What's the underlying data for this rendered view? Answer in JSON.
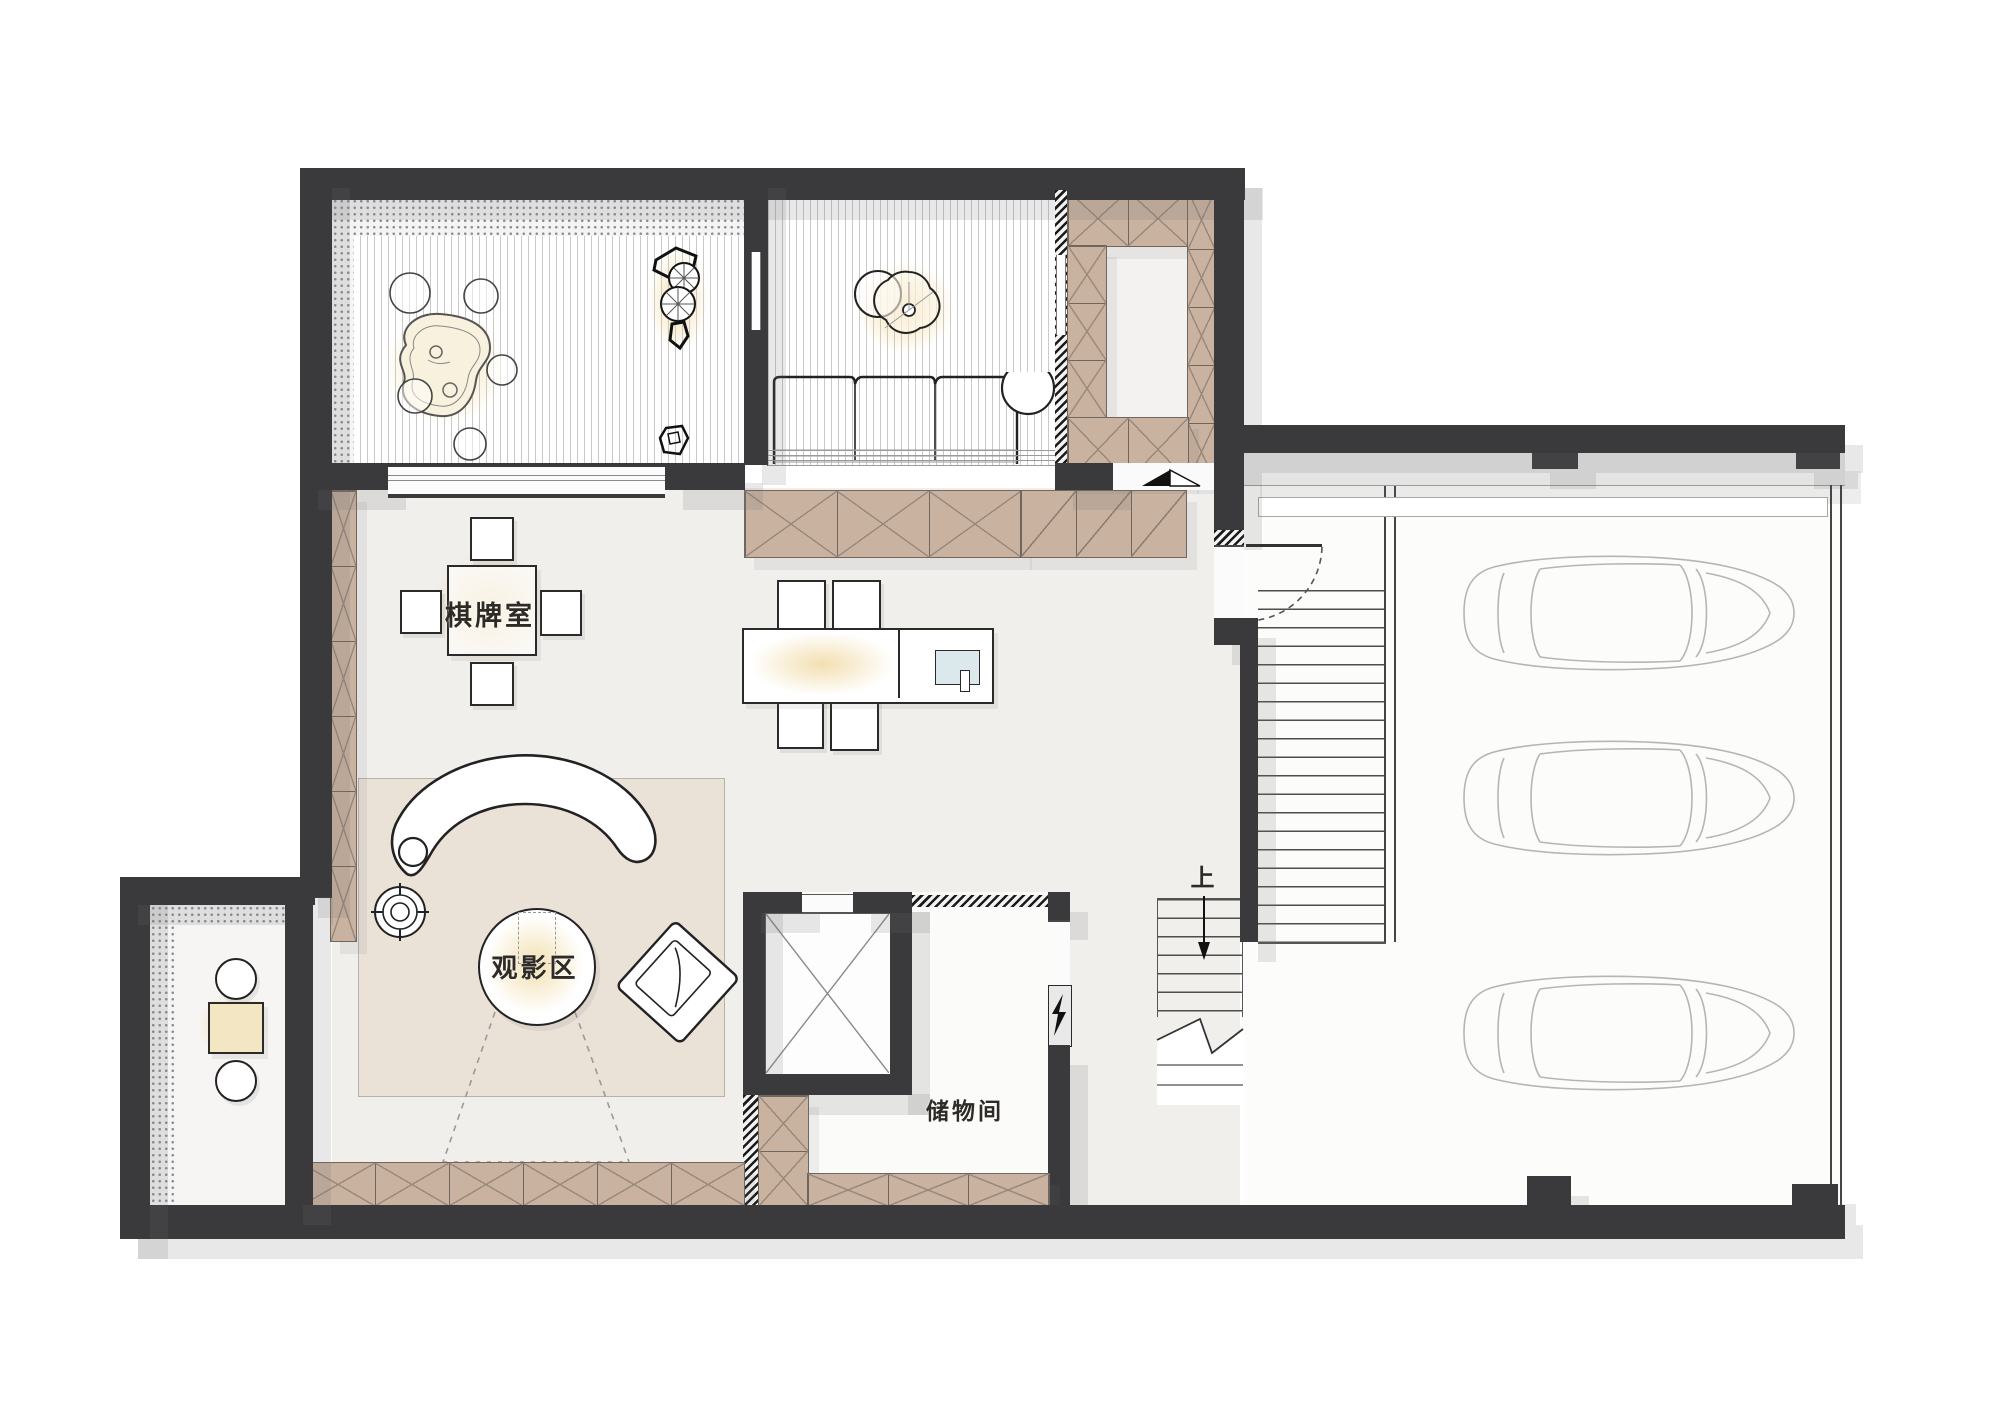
{
  "labels": {
    "chess_room": "棋牌室",
    "movie_area": "观影区",
    "storage_room": "储物间",
    "stair_up": "上"
  },
  "icons": [
    "elevator-cross-icon",
    "lightning-bolt-icon",
    "stair-up-arrow-icon",
    "break-line-icon",
    "door-swing-icon",
    "threshold-marker-icon",
    "car-icon",
    "plant-icon",
    "rock-icon",
    "floor-speaker-icon",
    "laptop-icon",
    "projector-outline-icon"
  ],
  "colors": {
    "wall": "#3a3a3c",
    "cabinet_wood": "#c9b2a0",
    "hall_floor": "#f1efec",
    "rug": "#eae1d7",
    "warm_glow": "#e9c670",
    "shadow": "#dedede",
    "laptop_screen": "#dce9ec",
    "car_outline": "#b5b5b5"
  }
}
